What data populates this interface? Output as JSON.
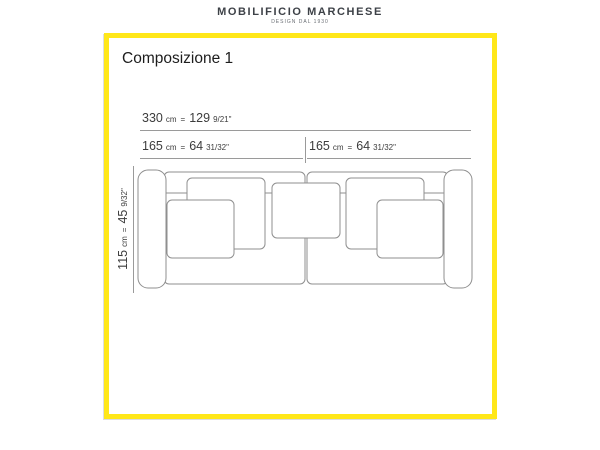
{
  "header": {
    "brand": "MOBILIFICIO MARCHESE",
    "tagline": "DESIGN DAL 1930"
  },
  "title": "Composizione 1",
  "dimensions": {
    "total": {
      "value": "330",
      "unit": "cm",
      "eq": "=",
      "inches": "129",
      "inches_frac": "9/21\""
    },
    "left": {
      "value": "165",
      "unit": "cm",
      "eq": "=",
      "inches": "64",
      "inches_frac": "31/32\""
    },
    "right": {
      "value": "165",
      "unit": "cm",
      "eq": "=",
      "inches": "64",
      "inches_frac": "31/32\""
    },
    "height": {
      "value": "115",
      "unit": "cm",
      "eq": "=",
      "inches": "45",
      "inches_frac": "9/32\""
    }
  },
  "diagram": {
    "subject": "sofa front elevation line drawing with two seats, two armrests and five cushions",
    "frame_color": "#ffe719",
    "line_color": "#9a9a9a",
    "sketch_color": "#8f8f8f"
  }
}
